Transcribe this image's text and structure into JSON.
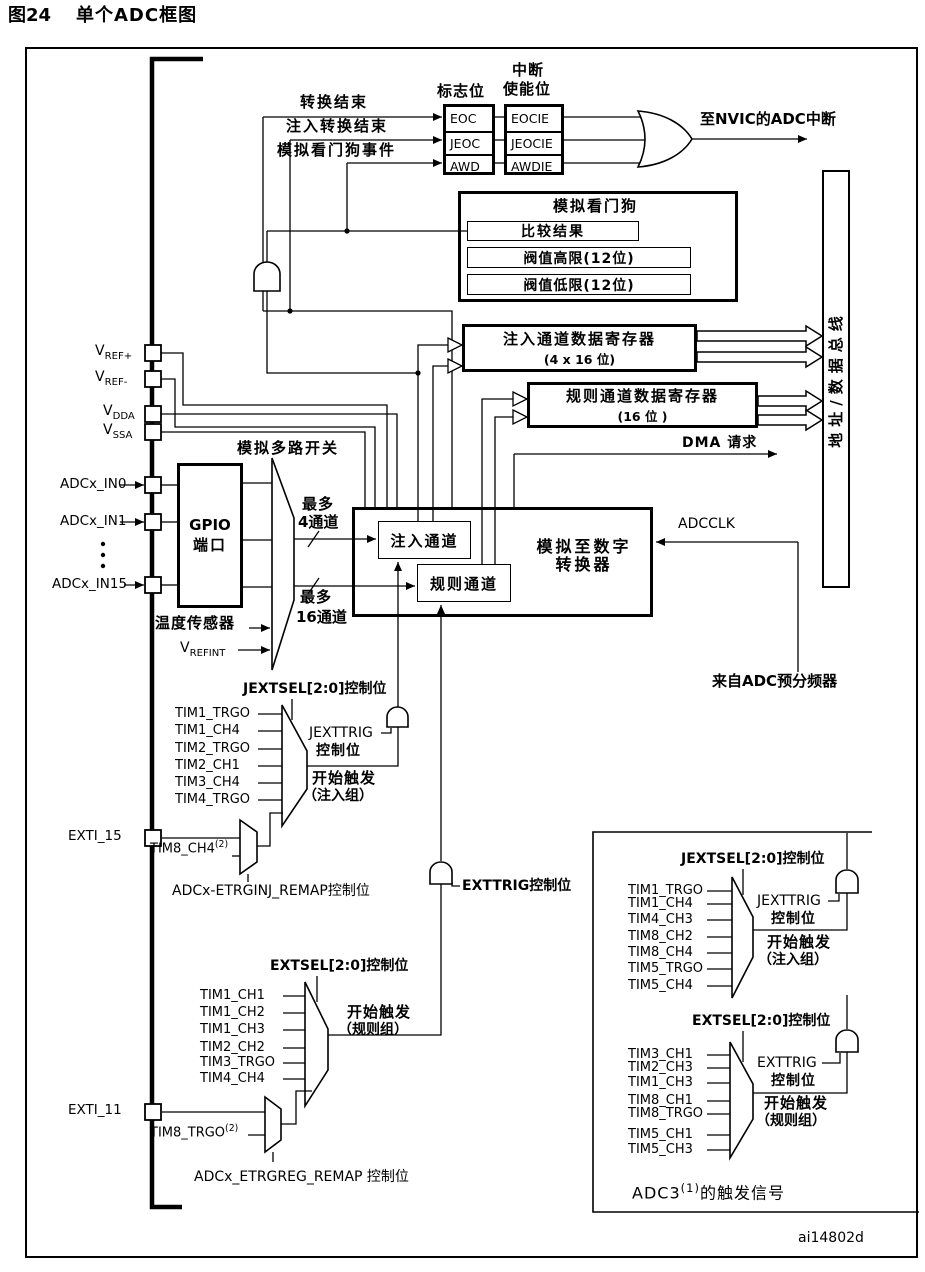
{
  "title": {
    "fig": "图24",
    "text": "单个ADC框图"
  },
  "colors": {
    "ink": "#000000",
    "paper": "#ffffff"
  },
  "flags": {
    "items": [
      "EOC",
      "JEOC",
      "AWD"
    ]
  },
  "enables": {
    "items": [
      "EOCIE",
      "JEOCIE",
      "AWDIE"
    ]
  },
  "watchdog": {
    "title": "模拟看门狗",
    "compare": "比较结果",
    "high": "阀值高限(12位)",
    "low": "阀值低限(12位)"
  },
  "registers": {
    "injected": "注入通道数据寄存器",
    "injected_size": "(4 x 16 位)",
    "regular": "规则通道数据寄存器",
    "regular_size": "(16 位 )"
  },
  "bus": {
    "label": "地址/数据总线"
  },
  "adc": {
    "injected": "注入通道",
    "regular": "规则通道",
    "converter_line1": "模拟至数字",
    "converter_line2": "转换器"
  },
  "gpio": {
    "line1": "GPIO",
    "line2": "端口"
  },
  "labels": {
    "ev_eoc": "转换结束",
    "ev_jeoc": "注入转换结束",
    "ev_awd": "模拟看门狗事件",
    "flags_title": "标志位",
    "en_title1": "中断",
    "en_title2": "使能位",
    "nvic": "至NVIC的ADC中断",
    "dma": "DMA 请求",
    "adcclk": "ADCCLK",
    "prescaler": "来自ADC预分频器",
    "mux_label": "模拟多路开关",
    "max4_1": "最多",
    "max4_2": "4通道",
    "max16_1": "最多",
    "max16_2": "16通道",
    "temp": "温度传感器",
    "vrefint": {
      "text": "V",
      "sub": "REFINT"
    },
    "vref_p": {
      "text": "V",
      "sub": "REF+"
    },
    "vref_m": {
      "text": "V",
      "sub": "REF-"
    },
    "vdda": {
      "text": "V",
      "sub": "DDA"
    },
    "vssa": {
      "text": "V",
      "sub": "SSA"
    },
    "in0": "ADCx_IN0",
    "in1": "ADCx_IN1",
    "in15": "ADCx_IN15",
    "exti15": "EXTI_15",
    "exti11": "EXTI_11",
    "jextsel_main": "JEXTSEL[2:0]控制位",
    "t1": "TIM1_TRGO",
    "t2": "TIM1_CH4",
    "t3": "TIM2_TRGO",
    "t4": "TIM2_CH1",
    "t5": "TIM3_CH4",
    "t6": "TIM4_TRGO",
    "jexttrig1": "JEXTTRIG",
    "jexttrig2": "控制位",
    "si1": "开始触发",
    "si2": "（注入组）",
    "tim8ch4": {
      "text": "TIM8_CH4",
      "sup": "(2)"
    },
    "remap_inj": "ADCx-ETRGINJ_REMAP控制位",
    "extsel_main": "EXTSEL[2:0]控制位",
    "r1": "TIM1_CH1",
    "r2": "TIM1_CH2",
    "r3": "TIM1_CH3",
    "r4": "TIM2_CH2",
    "r5": "TIM3_TRGO",
    "r6": "TIM4_CH4",
    "sr1": "开始触发",
    "sr2": "（规则组）",
    "exttrig_main": "EXTTRIG控制位",
    "tim8trgo": {
      "text": "TIM8_TRGO",
      "sup": "(2)"
    },
    "remap_reg": "ADCx_ETRGREG_REMAP 控制位",
    "i_jextsel": "JEXTSEL[2:0]控制位",
    "it1": "TIM1_TRGO",
    "it2": "TIM1_CH4",
    "it3": "TIM4_CH3",
    "it4": "TIM8_CH2",
    "it5": "TIM8_CH4",
    "it6": "TIM5_TRGO",
    "it7": "TIM5_CH4",
    "i_jexttrig1": "JEXTTRIG",
    "i_jexttrig2": "控制位",
    "isi1": "开始触发",
    "isi2": "（注入组）",
    "i_extsel": "EXTSEL[2:0]控制位",
    "ir1": "TIM3_CH1",
    "ir2": "TIM2_CH3",
    "ir3": "TIM1_CH3",
    "ir4": "TIM8_CH1",
    "ir5": "TIM8_TRGO",
    "ir6": "TIM5_CH1",
    "ir7": "TIM5_CH3",
    "i_exttrig1": "EXTTRIG",
    "i_exttrig2": "控制位",
    "isr1": "开始触发",
    "isr2": "（规则组）",
    "adc3": {
      "text": "ADC3",
      "sup": "(1)",
      "tail": "的触发信号"
    },
    "watermark": "ai14802d"
  }
}
